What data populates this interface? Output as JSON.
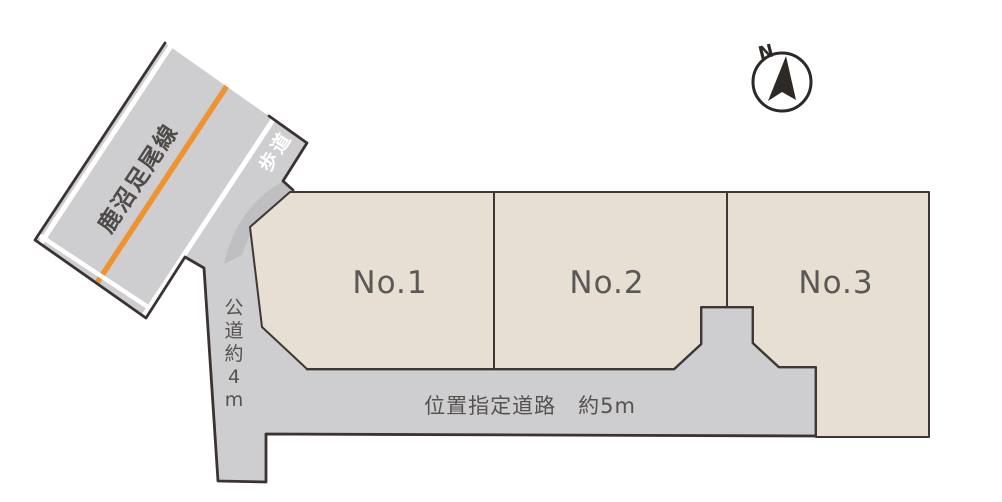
{
  "diagram": {
    "compass": {
      "north_label": "N"
    },
    "roads": {
      "route_name": "鹿沼足尾線",
      "sidewalk": "歩道",
      "public_road": "公道約4m",
      "designated_road": "位置指定道路　約5m"
    },
    "plots": [
      {
        "label": "No.1"
      },
      {
        "label": "No.2"
      },
      {
        "label": "No.3"
      }
    ],
    "colors": {
      "plot_fill": "#e7dfd2",
      "road_fill": "#cecdd0",
      "curb_shade": "#bfbec1",
      "outline": "#3b3331",
      "center_line_orange": "#ee9330",
      "label_gray": "#56524f",
      "stripe_white": "#ffffff"
    }
  }
}
